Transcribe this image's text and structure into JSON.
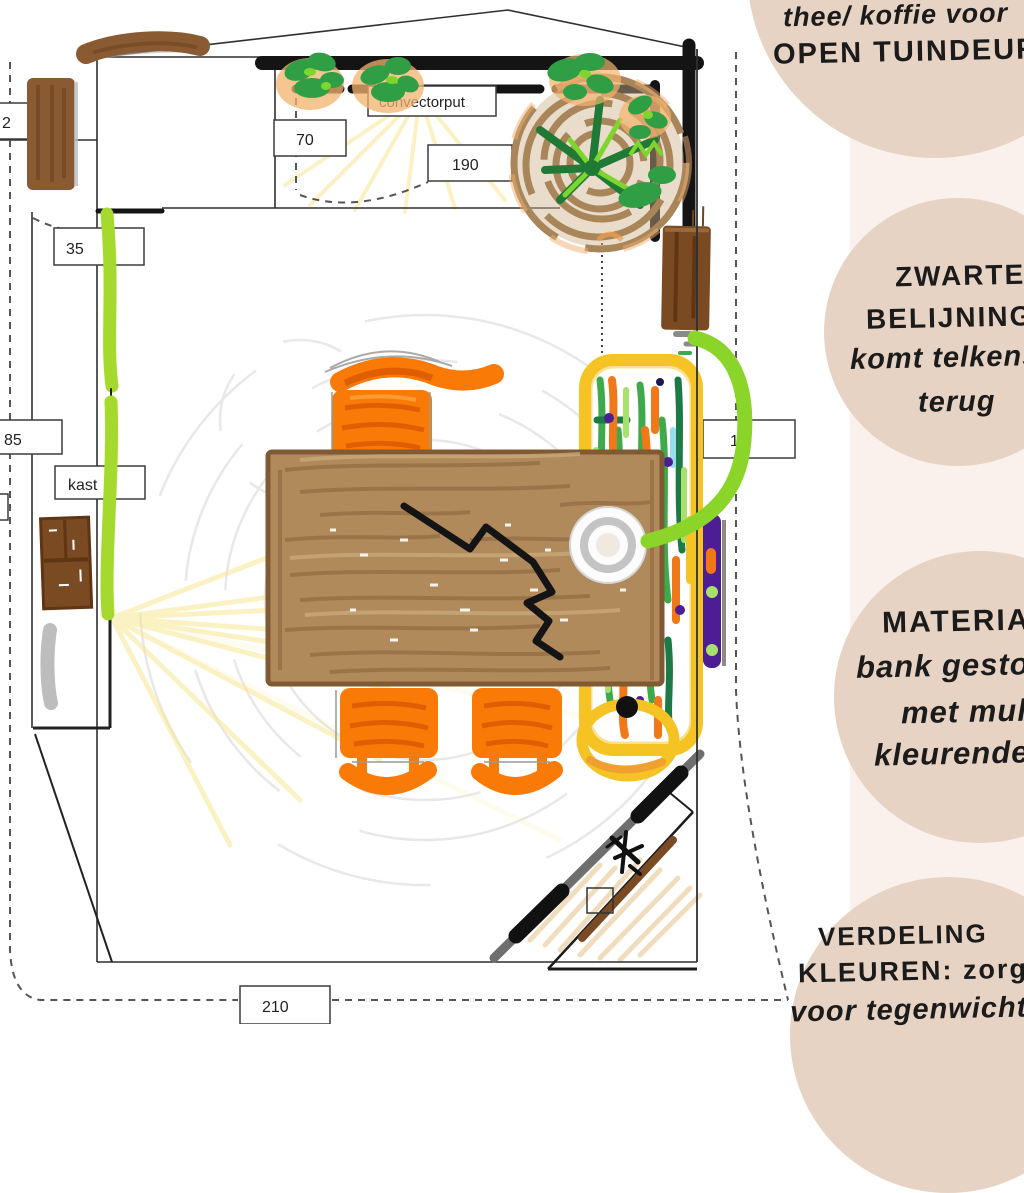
{
  "annotations": {
    "bubble1": {
      "line1": "thee/ koffie voor",
      "line2": "OPEN TUINDEUR"
    },
    "bubble2": {
      "line1": "ZWARTE",
      "line2": "BELIJNING",
      "line3": "komt telkens",
      "line4": "terug"
    },
    "bubble3": {
      "line1": "MATERIA",
      "line2": "bank gesto",
      "line3": "met mul",
      "line4": "kleurende"
    },
    "bubble4": {
      "line1": "VERDELING",
      "line2": "KLEUREN: zorg",
      "line3": "voor tegenwicht"
    }
  },
  "measurements": {
    "left_edge": "2",
    "w35": "35",
    "w85": "85",
    "kast": "kast",
    "convectorput": "convectorput",
    "w70": "70",
    "w190": "190",
    "w15": "15",
    "w210": "210"
  },
  "colors": {
    "bubble_beige": "#e7d3c4",
    "stripe_pink": "#faf0ec",
    "chair_orange": "#f97a07",
    "table_wood": "#b18a5c",
    "accent_green_line": "#a6d92e",
    "bench_yellow": "#f5c324",
    "purple_bar": "#4c1d95",
    "ink_black": "#141414"
  }
}
